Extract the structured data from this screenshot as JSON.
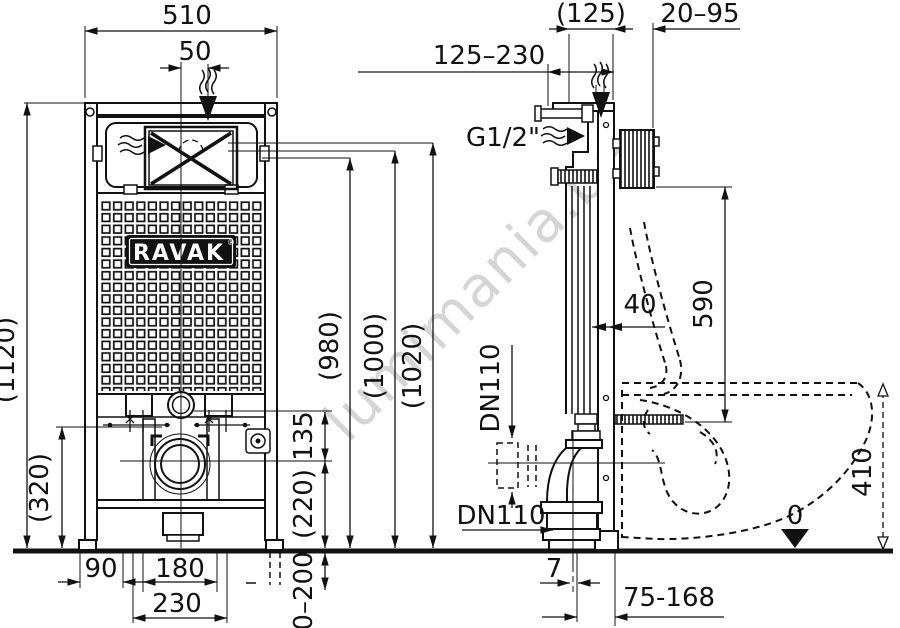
{
  "watermark": "lumimania.be",
  "logo": {
    "text": "RAVAK",
    "reg": "®"
  },
  "front_view": {
    "dims": {
      "width": "510",
      "inlet_offset": "50",
      "height_total": "(1120)",
      "height_lower": "(320)",
      "level_980": "(980)",
      "level_1000": "(1000)",
      "level_1020": "(1020)",
      "flush_to_drain": "135",
      "drain_to_floor": "(220)",
      "leg_adjust": "0–200",
      "edge_to_leg": "90",
      "leg_spacing": "180",
      "leg_outer": "230"
    }
  },
  "side_view": {
    "dims": {
      "depth": "(125)",
      "bracket_adjust": "20–95",
      "supply_reach": "125–230",
      "supply_thread": "G1/2\"",
      "bend_offset": "40",
      "supply_to_seat": "590",
      "drain_vertical": "DN110",
      "drain_horizontal": "DN110",
      "bowl_height": "410",
      "floor_level": "0",
      "outlet_offset": "7",
      "outlet_adjust": "75-168"
    }
  }
}
